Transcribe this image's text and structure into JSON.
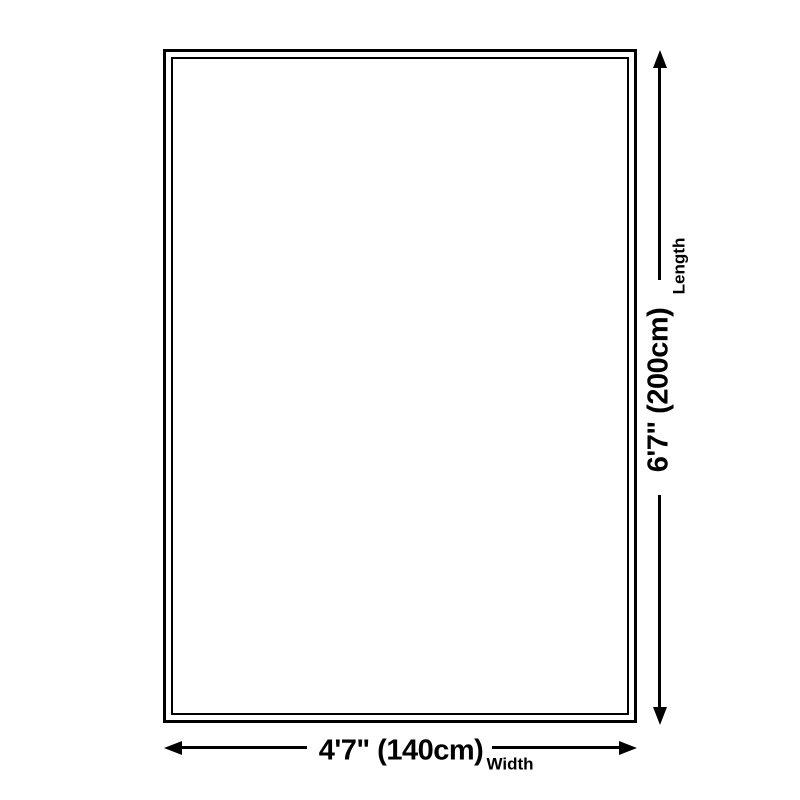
{
  "diagram": {
    "background_color": "#ffffff",
    "line_color": "#000000",
    "text_color": "#000000",
    "length": {
      "value": "6'7\" (200cm)",
      "label": "Length"
    },
    "width": {
      "value": "4'7\" (140cm)",
      "label": "Width"
    }
  }
}
